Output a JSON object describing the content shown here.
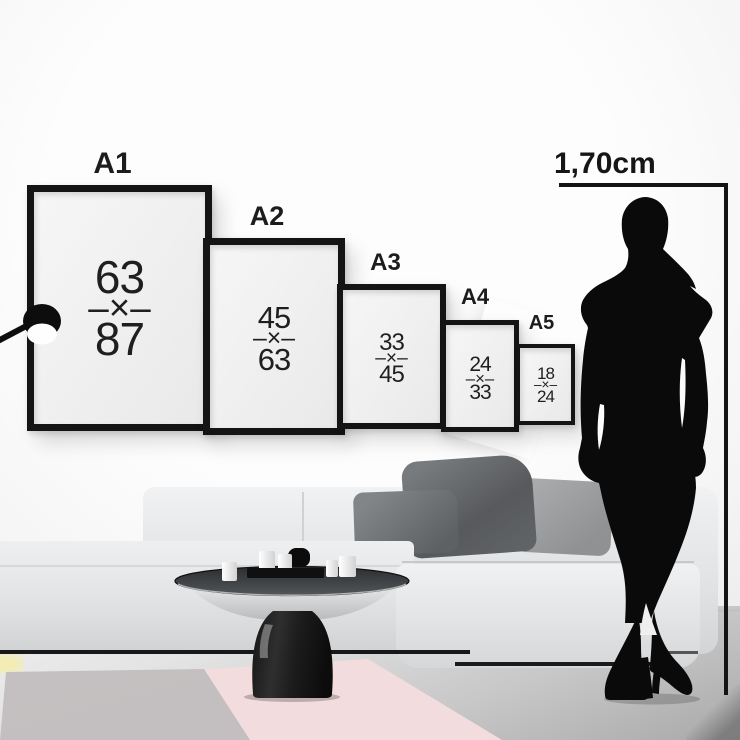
{
  "poster_guide": {
    "frames": [
      {
        "label": "A1",
        "top": "63",
        "sep": "–×–",
        "bottom": "87"
      },
      {
        "label": "A2",
        "top": "45",
        "sep": "–×–",
        "bottom": "63"
      },
      {
        "label": "A3",
        "top": "33",
        "sep": "–×–",
        "bottom": "45"
      },
      {
        "label": "A4",
        "top": "24",
        "sep": "–×–",
        "bottom": "33"
      },
      {
        "label": "A5",
        "top": "18",
        "sep": "–×–",
        "bottom": "24"
      }
    ],
    "person_height_label": "1,70cm"
  },
  "icons": {
    "lamp": "wall-lamp-icon",
    "person": "female-silhouette",
    "sofa": "sofa",
    "coffee_table": "coffee-table"
  },
  "colors": {
    "frame_black": "#141414",
    "wall_white": "#fbfbfb",
    "sofa_gray": "#e9ebec",
    "pillow_dark": "#5f6265",
    "pillow_light": "#9fa1a2",
    "rug_pink": "#f5e1e3",
    "rug_gray": "#c8c5c6",
    "rug_yellow": "#f4eebb",
    "floor_gray": "#c9c9c9",
    "table_black": "#151515"
  }
}
